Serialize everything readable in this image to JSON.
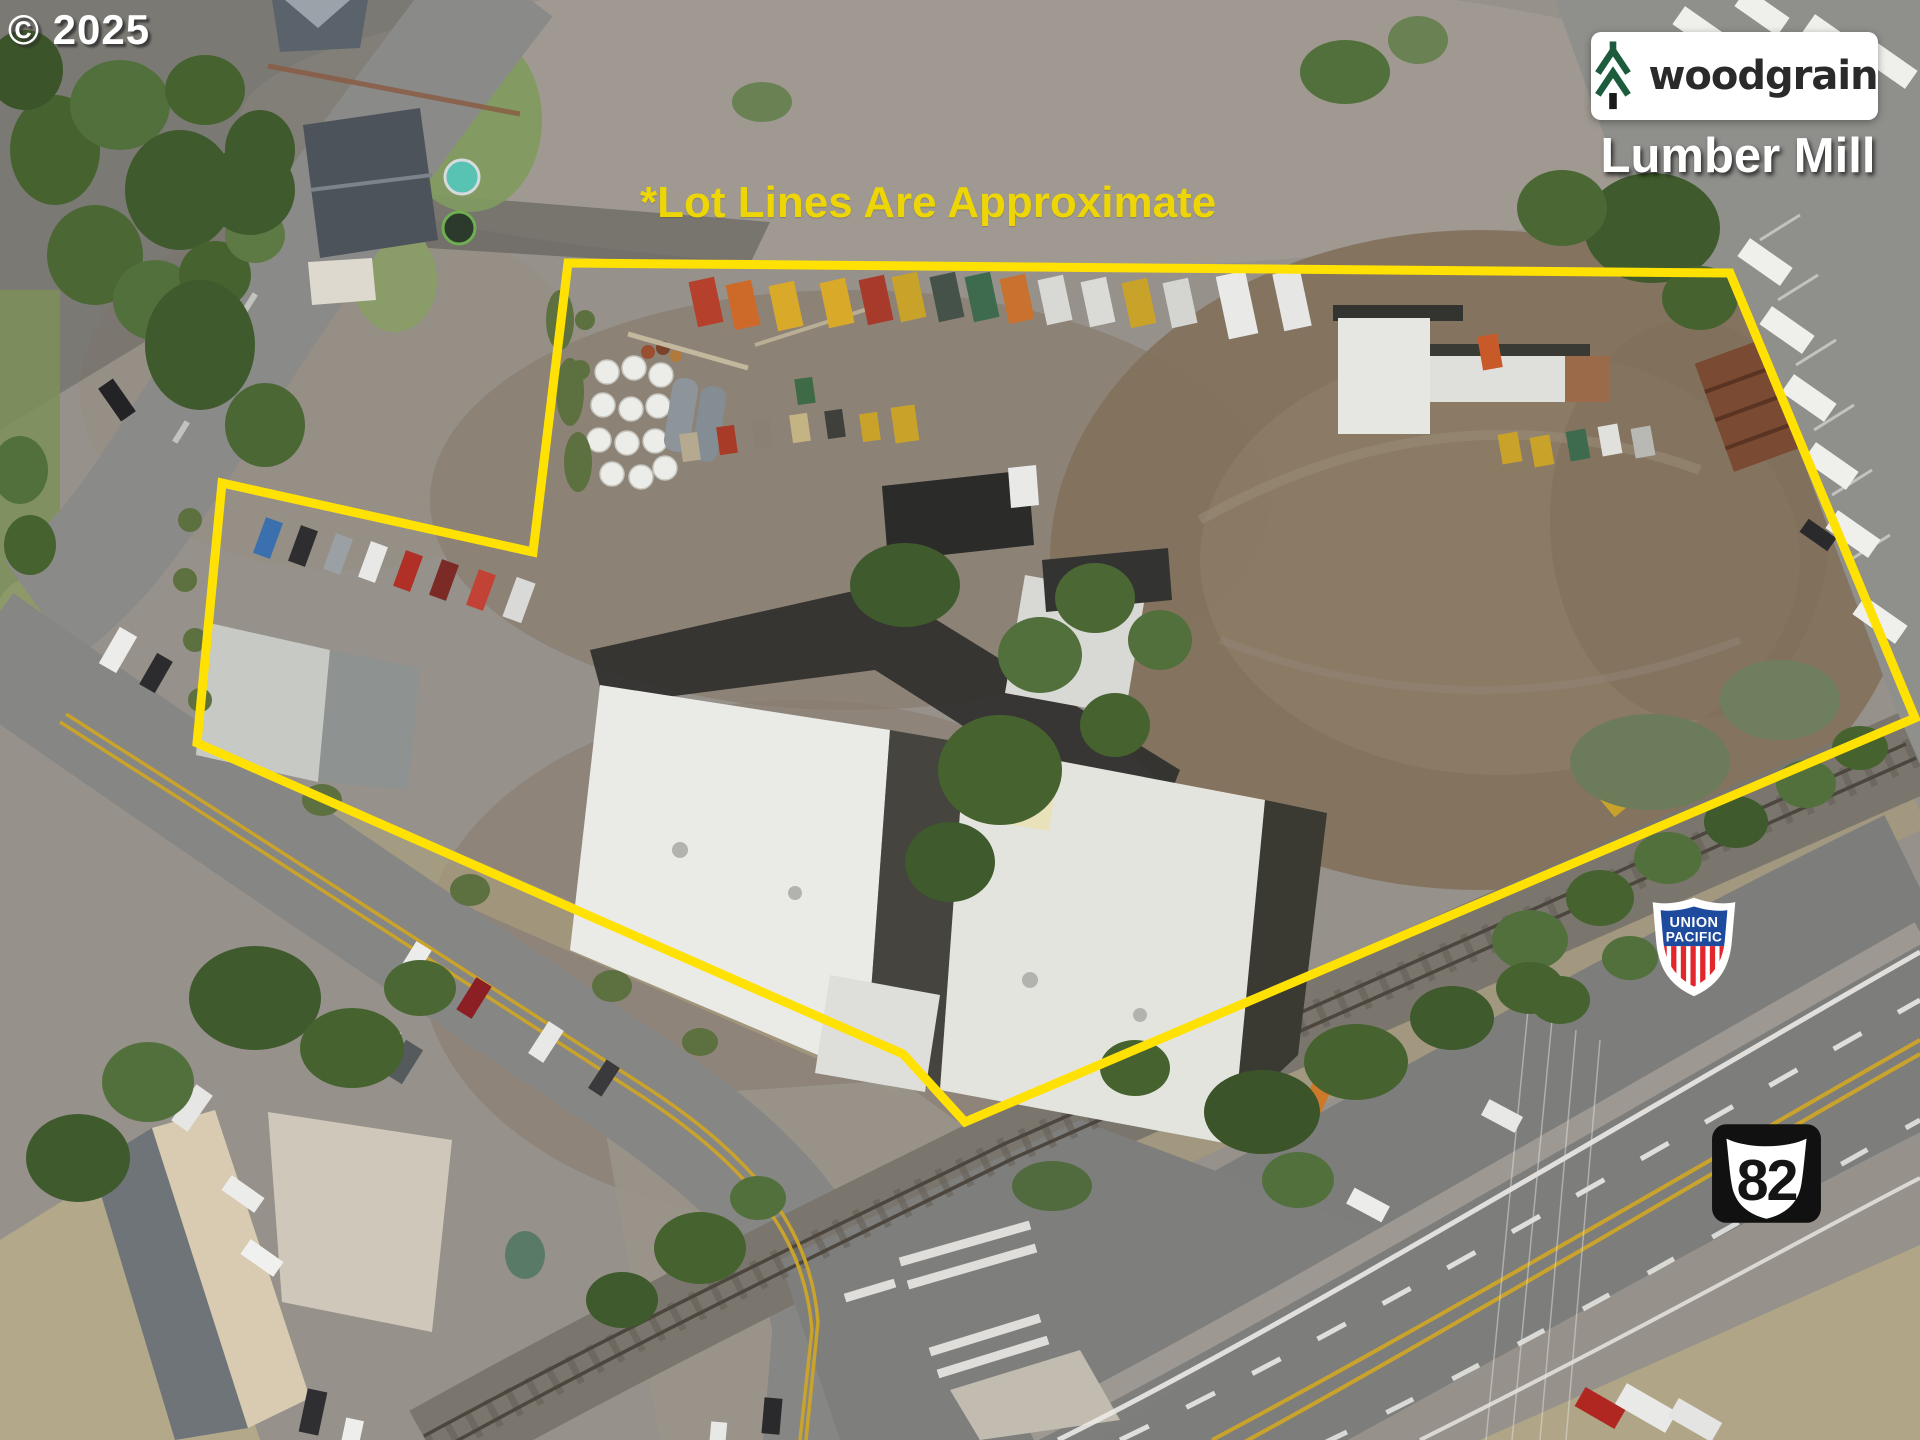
{
  "overlay": {
    "copyright": "© 2025",
    "note": "*Lot Lines Are Approximate"
  },
  "branding": {
    "wordmark": "woodgrain",
    "caption": "Lumber Mill",
    "box_color": "#FFFFFF",
    "tree_green": "#1D5B3D",
    "trunk_color": "#1A1A1A",
    "wordmark_color": "#2A2A2A"
  },
  "lot_line": {
    "points": "568,263 1730,273 1915,718 965,1122 903,1054 197,743 222,483 533,552",
    "color": "#FFE104",
    "note_color": "#EDD506",
    "width": "9"
  },
  "railroad_shield": {
    "line1": "UNION",
    "line2": "PACIFIC",
    "blue": "#1E4B9E",
    "red": "#E3262C"
  },
  "route_shield": {
    "number": "82",
    "background": "#111111",
    "foreground": "#FFFFFF"
  }
}
